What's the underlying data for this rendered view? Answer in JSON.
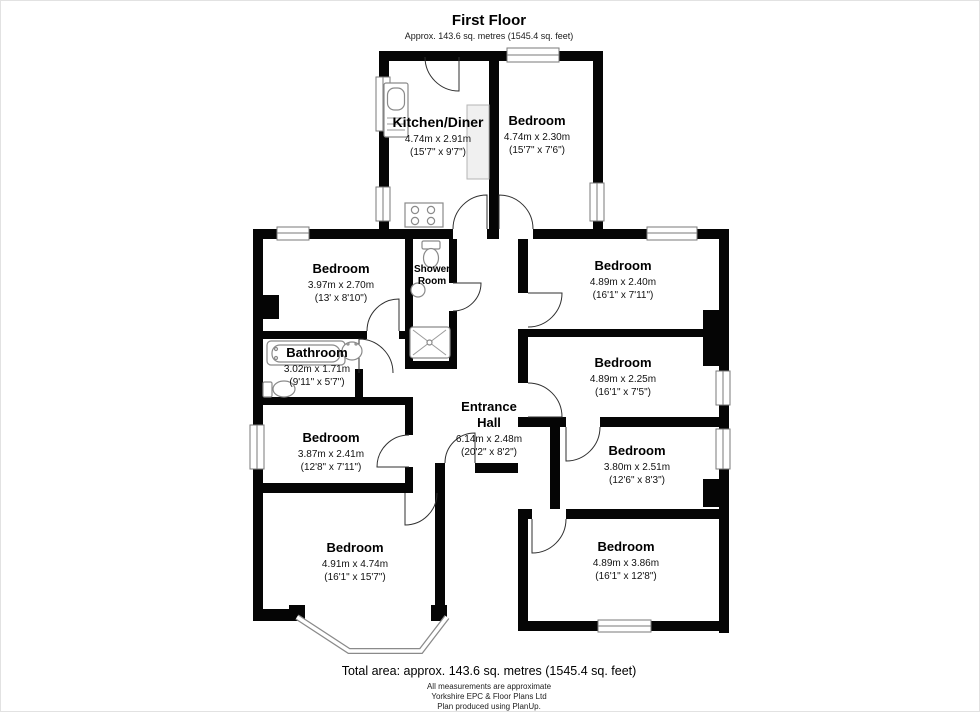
{
  "title": "First Floor",
  "subtitle": "Approx. 143.6 sq. metres (1545.4 sq. feet)",
  "footer": {
    "total_area": "Total area: approx. 143.6 sq. metres (1545.4 sq. feet)",
    "note1": "All measurements are approximate",
    "note2": "Yorkshire EPC & Floor Plans Ltd",
    "note3": "Plan produced using PlanUp."
  },
  "colors": {
    "wall": "#050505",
    "room_fill": "#ffffff",
    "window_stroke": "#7a7a7a",
    "door_stroke": "#2f2f2f"
  },
  "fixtures": [
    "kitchen-sink",
    "hob",
    "toilet",
    "wash-basin",
    "shower-tray",
    "bathtub",
    "bay-window"
  ],
  "rooms": [
    {
      "key": "kitchen-diner",
      "lines": [
        "Kitchen/Diner",
        "4.74m x 2.91m",
        "(15'7\" x 9'7\")"
      ]
    },
    {
      "key": "bedroom-top",
      "lines": [
        "Bedroom",
        "4.74m x 2.30m",
        "(15'7\" x 7'6\")"
      ]
    },
    {
      "key": "bedroom-upper-left",
      "lines": [
        "Bedroom",
        "3.97m x 2.70m",
        "(13' x 8'10\")"
      ]
    },
    {
      "key": "shower-room",
      "lines": [
        "Shower",
        "Room"
      ]
    },
    {
      "key": "bedroom-upper-right",
      "lines": [
        "Bedroom",
        "4.89m x 2.40m",
        "(16'1\" x 7'11\")"
      ]
    },
    {
      "key": "bathroom",
      "lines": [
        "Bathroom",
        "3.02m x 1.71m",
        "(9'11\" x 5'7\")"
      ]
    },
    {
      "key": "bedroom-middle-right",
      "lines": [
        "Bedroom",
        "4.89m x 2.25m",
        "(16'1\" x 7'5\")"
      ]
    },
    {
      "key": "entrance-hall",
      "lines": [
        "Entrance",
        "Hall",
        "6.14m x 2.48m",
        "(20'2\" x 8'2\")"
      ]
    },
    {
      "key": "bedroom-middle-left",
      "lines": [
        "Bedroom",
        "3.87m x 2.41m",
        "(12'8\" x 7'11\")"
      ]
    },
    {
      "key": "bedroom-lower-right",
      "lines": [
        "Bedroom",
        "3.80m x 2.51m",
        "(12'6\" x 8'3\")"
      ]
    },
    {
      "key": "bedroom-bottom-left",
      "lines": [
        "Bedroom",
        "4.91m x 4.74m",
        "(16'1\" x 15'7\")"
      ]
    },
    {
      "key": "bedroom-bottom-right",
      "lines": [
        "Bedroom",
        "4.89m x 3.86m",
        "(16'1\" x 12'8\")"
      ]
    }
  ]
}
